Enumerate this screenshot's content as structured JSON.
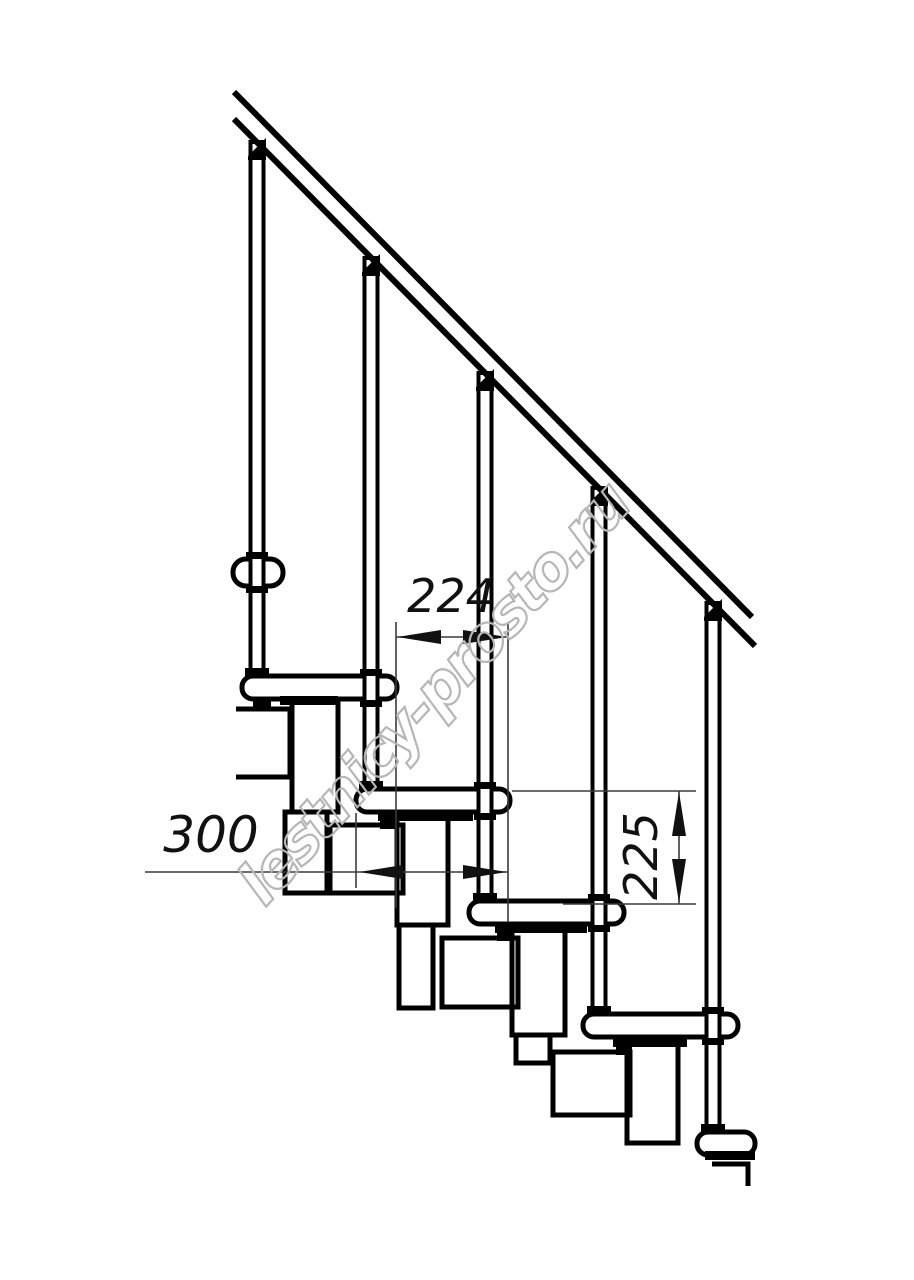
{
  "figure": {
    "watermark_text": "lestnicy-prosto.ru",
    "dimensions": {
      "step_run": "224",
      "tread_depth": "300",
      "step_rise": "225"
    },
    "colors": {
      "line": "#000000",
      "dimension_text": "#111111",
      "watermark": "#b6b6b6",
      "background": "#ffffff"
    }
  }
}
